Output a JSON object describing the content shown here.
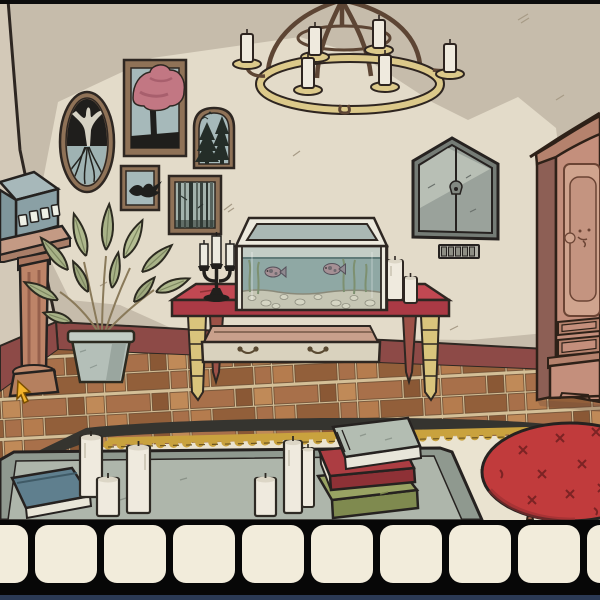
{
  "scene": {
    "description": "hand-drawn living room in a point-and-click escape game",
    "objects": [
      {
        "name": "chandelier",
        "candles": 6
      },
      {
        "name": "oval-picture-tree-roots"
      },
      {
        "name": "picture-pink-tree"
      },
      {
        "name": "picture-pine-trees"
      },
      {
        "name": "picture-swallow"
      },
      {
        "name": "picture-birch-forest"
      },
      {
        "name": "wall-cabinet",
        "state": "closed",
        "keyhole": true
      },
      {
        "name": "code-panel",
        "slots": 5
      },
      {
        "name": "armoire"
      },
      {
        "name": "red-table"
      },
      {
        "name": "open-drawer",
        "state": "open",
        "handles": 2
      },
      {
        "name": "fish-tank",
        "fish_count": 2
      },
      {
        "name": "candelabra",
        "candles": 3
      },
      {
        "name": "table-candles",
        "count": 2
      },
      {
        "name": "pedestal-device",
        "keys": 4
      },
      {
        "name": "potted-plant"
      },
      {
        "name": "rug"
      },
      {
        "name": "coffee-table",
        "candles": 6
      },
      {
        "name": "blue-book"
      },
      {
        "name": "book-stack",
        "books": [
          "green",
          "red",
          "gray"
        ]
      },
      {
        "name": "red-ottoman"
      }
    ],
    "cursor": {
      "visible": true,
      "x": 18,
      "y": 382
    }
  },
  "inventory": {
    "slot_count": 10,
    "items": []
  },
  "colors": {
    "wall": "#c6bcab",
    "wall_light": "#e3dbc9",
    "left_wall": "#d3c9b8",
    "outline": "#2e2722",
    "baseboard": "#8d4a47",
    "floor_grout": "#d4bf97",
    "floor_a": "#a8704a",
    "floor_b": "#8a5835",
    "floor_c": "#c08a58",
    "floor_d": "#b57c4e",
    "floor_e": "#925f3a",
    "rug_dark": "#35342f",
    "rug_trim": "#c9a23e",
    "rug_inner": "#eae3d0",
    "chandelier_ring": "#dcc98a",
    "chandelier_arm": "#5d4534",
    "candle": "#efeade",
    "frame_wood": "#8f7257",
    "art_bg": "#a6b9ba",
    "art_dark": "#1f1e1c",
    "art_tree_pink": "#c27783",
    "art_white": "#d6d2c4",
    "cabinet_frame": "#757c76",
    "cabinet_door": "#9aa29b",
    "cabinet_highlight": "#bdc4ba",
    "code_panel": "#b0afa5",
    "code_slot": "#8e8e84",
    "armoire_front": "#c48f7c",
    "armoire_side": "#8d5f55",
    "armoire_trim": "#b5826d",
    "armoire_panel": "#d0a48e",
    "armoire_panel_inner": "#c49480",
    "table_top": "#c24852",
    "table_apron": "#ab3a45",
    "leg_yellow": "#d9c47c",
    "leg_red": "#9c5147",
    "drawer_face": "#d9d2be",
    "drawer_inside": "#c9a08c",
    "tank_frame": "#ece9dd",
    "tank_water": "#8fa8a4",
    "gravel": "#c6c6b4",
    "seaweed": "#7d9070",
    "fish": "#a59095",
    "candelabra": "#211f1c",
    "device_top": "#a7b8ba",
    "device_front": "#8aa0a5",
    "device_key": "#eef0e6",
    "pedestal": "#bd8468",
    "pot": "#b4bfb8",
    "leaf": "#a8b287",
    "ctable_rim": "#8f998f",
    "ctable_top": "#aeb6ab",
    "book_blue": "#5f7f8e",
    "book_green": "#99a363",
    "book_red": "#ac3d42",
    "book_gray": "#b3bdb2",
    "ottoman": "#c13b3c",
    "ottoman_leg": "#9c5b45",
    "cursor": "#f2b32b",
    "inventory_bg": "#070707",
    "inventory_slot": "#f2ecdb",
    "inventory_bottom_strip": "#2b3a55"
  }
}
